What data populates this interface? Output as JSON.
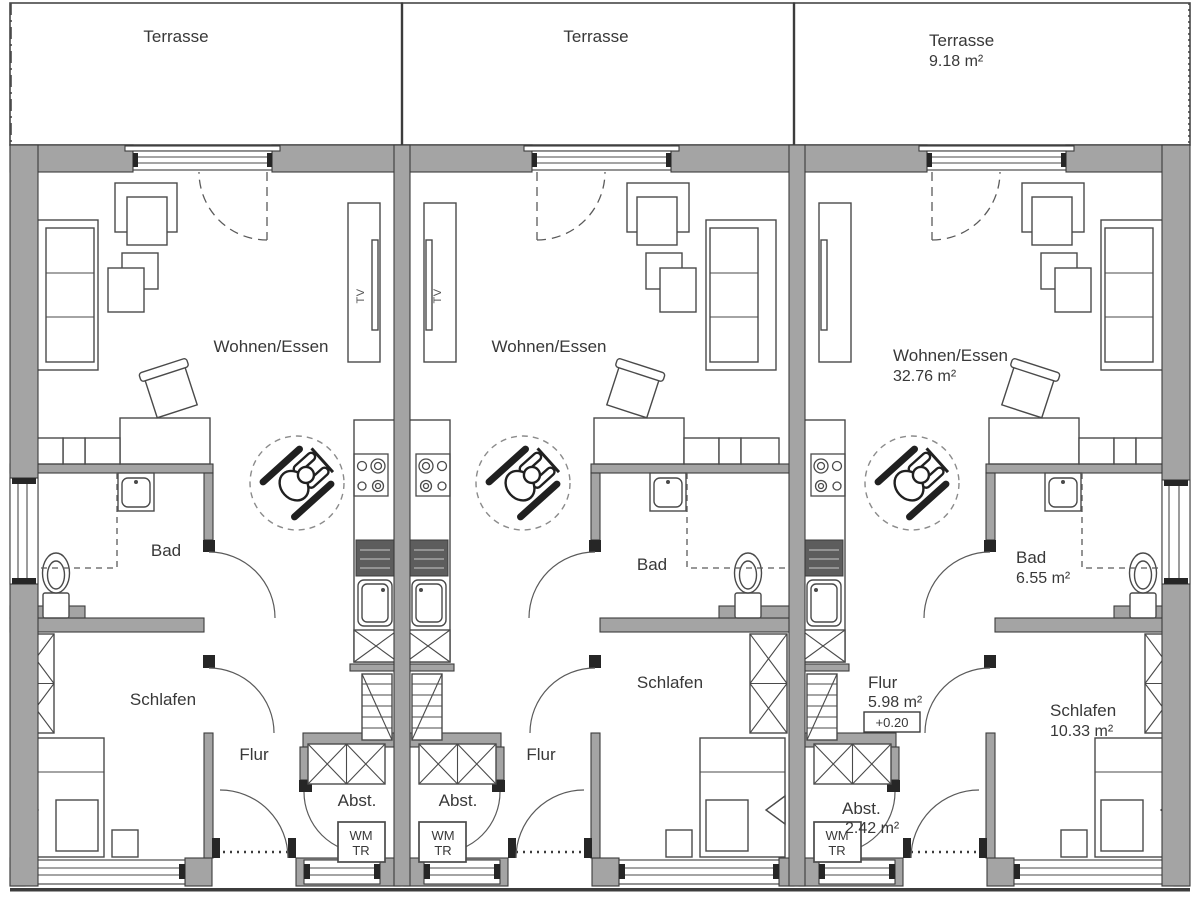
{
  "plan": {
    "colors": {
      "wall_gray": "#a4a4a4",
      "line_dark": "#3c3c3c",
      "label_text": "#383838"
    },
    "units": [
      {
        "id": "1",
        "terrasse": {
          "label": "Terrasse"
        },
        "wohnen_essen": {
          "label": "Wohnen/Essen"
        },
        "bad": {
          "label": "Bad"
        },
        "schlafen": {
          "label": "Schlafen"
        },
        "flur": {
          "label": "Flur"
        },
        "abstellraum": {
          "label": "Abst."
        },
        "appliance": {
          "line1": "WM",
          "line2": "TR"
        },
        "tv": "TV"
      },
      {
        "id": "2",
        "terrasse": {
          "label": "Terrasse"
        },
        "wohnen_essen": {
          "label": "Wohnen/Essen"
        },
        "bad": {
          "label": "Bad"
        },
        "schlafen": {
          "label": "Schlafen"
        },
        "flur": {
          "label": "Flur"
        },
        "abstellraum": {
          "label": "Abst."
        },
        "appliance": {
          "line1": "WM",
          "line2": "TR"
        },
        "tv": "TV"
      },
      {
        "id": "3",
        "terrasse": {
          "label": "Terrasse",
          "area": "9.18 m²"
        },
        "wohnen_essen": {
          "label": "Wohnen/Essen",
          "area": "32.76 m²"
        },
        "bad": {
          "label": "Bad",
          "area": "6.55 m²"
        },
        "schlafen": {
          "label": "Schlafen",
          "area": "10.33 m²"
        },
        "flur": {
          "label": "Flur",
          "area": "5.98 m²",
          "level": "+0.20"
        },
        "abstellraum": {
          "label": "Abst.",
          "area": "2.42 m²"
        },
        "appliance": {
          "line1": "WM",
          "line2": "TR"
        }
      }
    ]
  }
}
